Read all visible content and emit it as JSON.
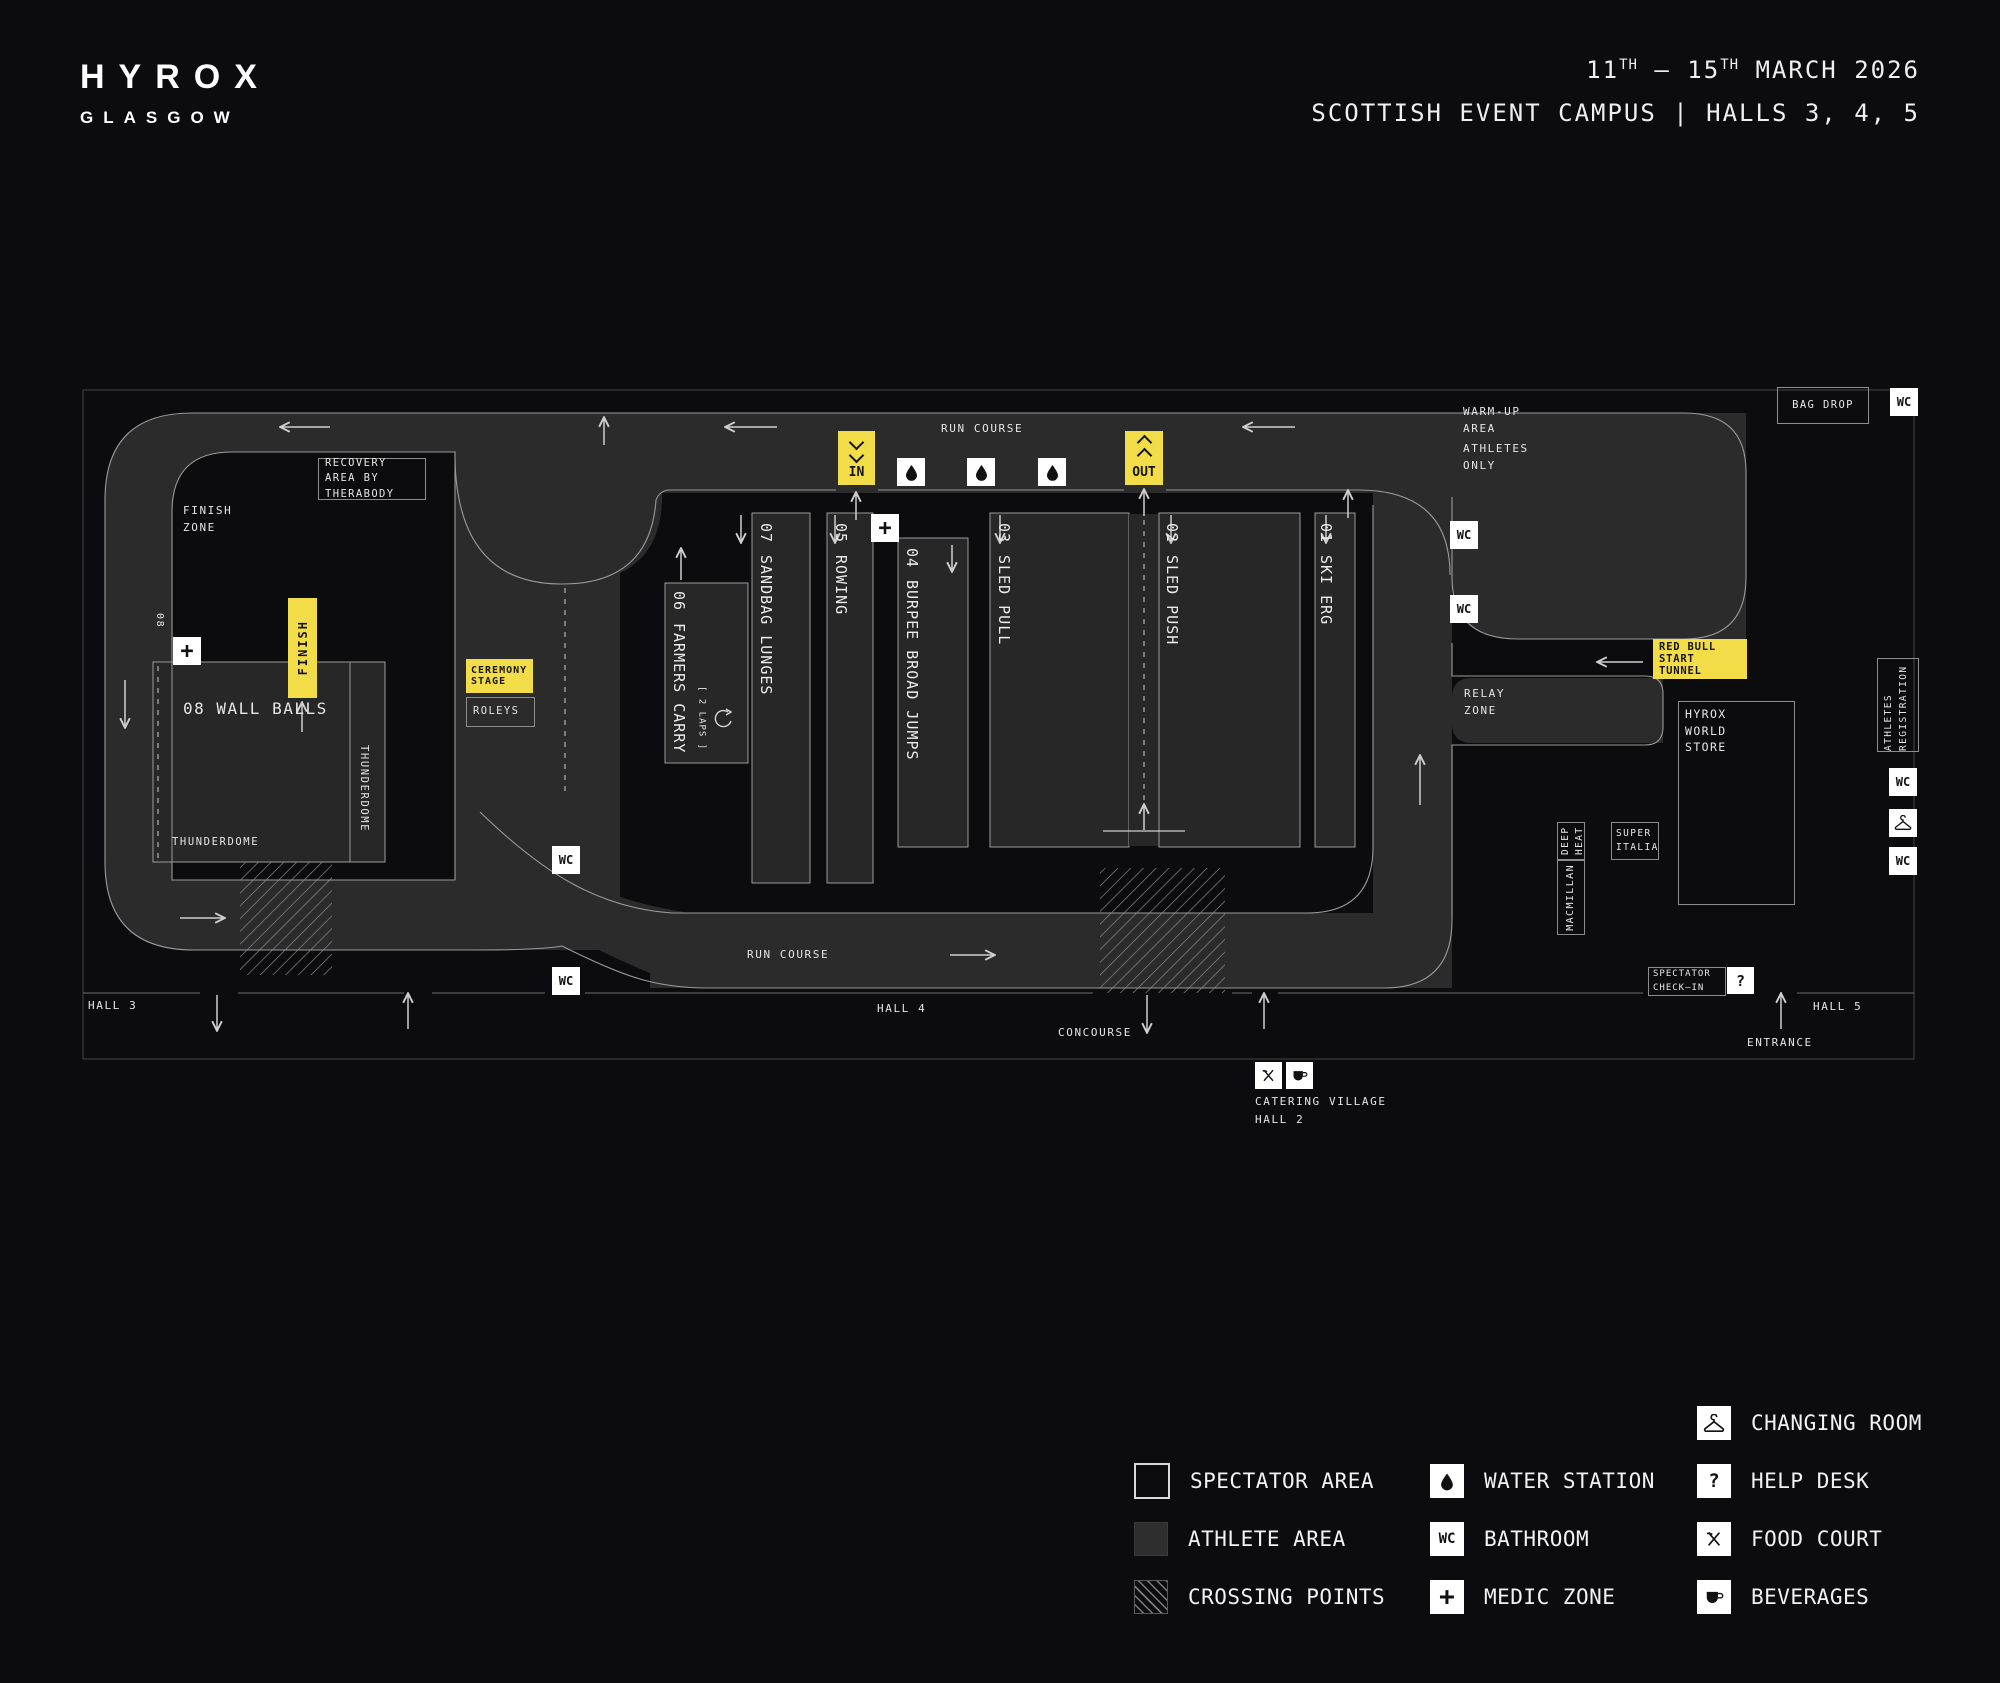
{
  "header": {
    "brand": "HYROX",
    "city": "GLASGOW",
    "date": {
      "d1": "11",
      "s1": "TH",
      "mid": " — 15",
      "s2": "TH",
      "rest": " MARCH 2026"
    },
    "venue": "SCOTTISH EVENT CAMPUS | HALLS 3, 4, 5"
  },
  "stations": [
    {
      "num": "01",
      "name": "SKI ERG"
    },
    {
      "num": "02",
      "name": "SLED PUSH"
    },
    {
      "num": "03",
      "name": "SLED PULL"
    },
    {
      "num": "04",
      "name": "BURPEE BROAD JUMPS"
    },
    {
      "num": "05",
      "name": "ROWING"
    },
    {
      "num": "06",
      "name": "FARMERS CARRY"
    },
    {
      "num": "07",
      "name": "SANDBAG LUNGES"
    },
    {
      "num": "08",
      "name": "WALL BALLS"
    }
  ],
  "map": {
    "labels": {
      "run_course": "RUN COURSE",
      "finish_zone": "FINISH ZONE",
      "recovery": "RECOVERY AREA BY THERABODY",
      "thunderdome": "THUNDERDOME",
      "finish": "FINISH",
      "ceremony_stage": "CEREMONY STAGE",
      "roleys": "ROLEYS",
      "laps": "[ 2 LAPS ]",
      "in": "IN",
      "out": "OUT",
      "warm_up": "WARM-UP AREA",
      "athletes_only": "ATHLETES ONLY",
      "relay_zone": "RELAY ZONE",
      "red_bull": "RED BULL START TUNNEL",
      "bag_drop": "BAG DROP",
      "hyrox_store": "HYROX WORLD STORE",
      "super_italia": "SUPER ITALIA",
      "deep_heat": "DEEP HEAT",
      "macmillan": "MACMILLAN",
      "athletes_registration": "ATHLETES REGISTRATION",
      "spectator_checkin": "SPECTATOR CHECK—IN",
      "hall3": "HALL 3",
      "hall4": "HALL 4",
      "hall5": "HALL 5",
      "concourse": "CONCOURSE",
      "entrance": "ENTRANCE",
      "catering_village": "CATERING VILLAGE",
      "catering_hall": "HALL 2"
    },
    "icons": {
      "wc": "WC",
      "medic": "+",
      "help": "?"
    }
  },
  "legend": {
    "areas": [
      {
        "id": "spectator",
        "label": "SPECTATOR AREA"
      },
      {
        "id": "athlete",
        "label": "ATHLETE AREA"
      },
      {
        "id": "crossing",
        "label": "CROSSING POINTS"
      }
    ],
    "services": [
      {
        "icon": "water",
        "label": "WATER STATION"
      },
      {
        "icon": "wc",
        "label": "BATHROOM"
      },
      {
        "icon": "medic",
        "label": "MEDIC ZONE"
      }
    ],
    "facilities": [
      {
        "icon": "hanger",
        "label": "CHANGING ROOM"
      },
      {
        "icon": "question",
        "label": "HELP DESK"
      },
      {
        "icon": "food",
        "label": "FOOD COURT"
      },
      {
        "icon": "cup",
        "label": "BEVERAGES"
      }
    ]
  },
  "colors": {
    "background": "#0c0c0e",
    "course": "#2b2b2c",
    "station": "#272728",
    "accent_yellow": "#f2dd49",
    "line": "#9a9a9a",
    "box_white": "#ffffff"
  }
}
